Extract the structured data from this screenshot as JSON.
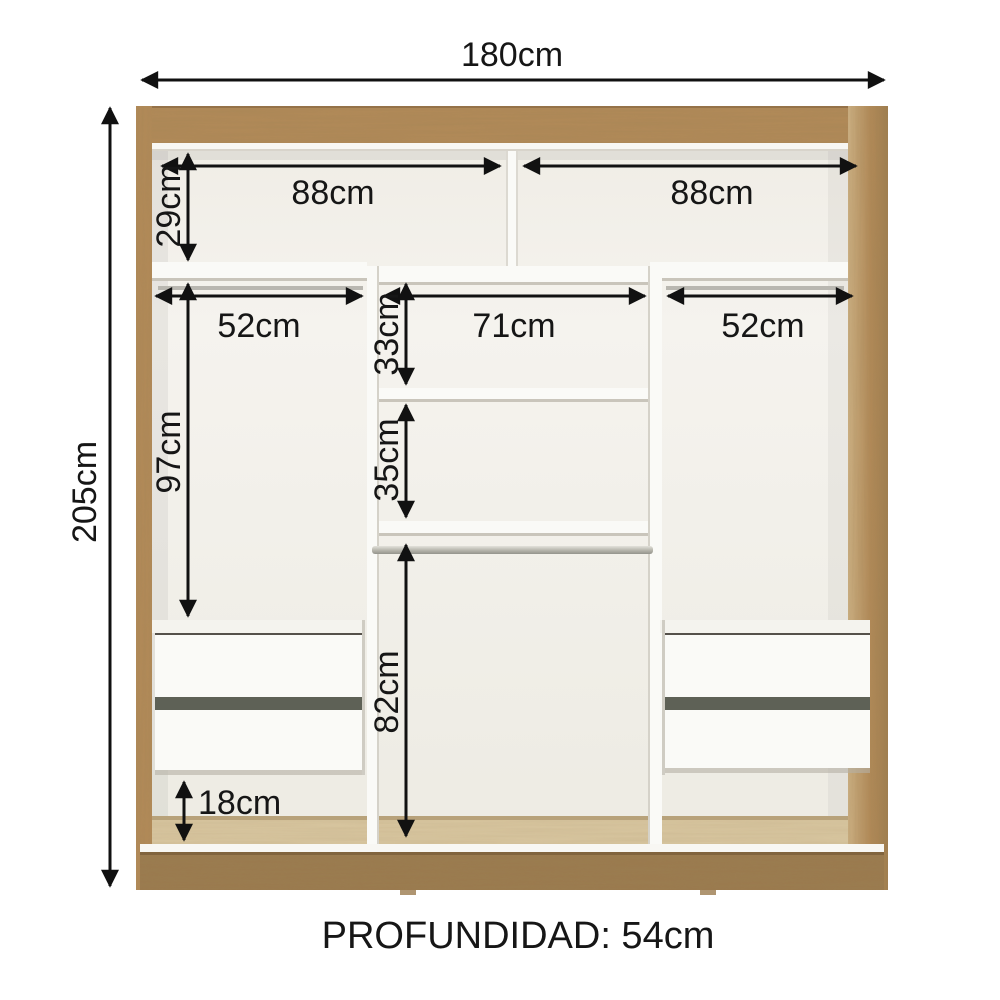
{
  "diagram": {
    "kind": "wardrobe-interior-dimensions",
    "dims": {
      "total_width": "180cm",
      "total_height": "205cm",
      "top_left_section_width": "88cm",
      "top_right_section_width": "88cm",
      "top_shelf_height": "29cm",
      "left_rod_width": "52cm",
      "center_section_width": "71cm",
      "right_rod_width": "52cm",
      "center_upper_shelf_height": "33cm",
      "left_hanging_height": "97cm",
      "center_middle_shelf_height": "35cm",
      "center_hanging_height": "82cm",
      "under_drawer_gap_height": "18cm"
    },
    "depth": {
      "label": "PROFUNDIDAD: 54cm"
    },
    "colors": {
      "wood": "#b28a58",
      "wood_dark": "#9b7a4e",
      "floor_wood": "#d8c6a0",
      "interior": "#f3f1eb",
      "white_panel": "#fafaf7",
      "drawer_gap": "#5e6156",
      "dimension_line": "#111111"
    }
  }
}
